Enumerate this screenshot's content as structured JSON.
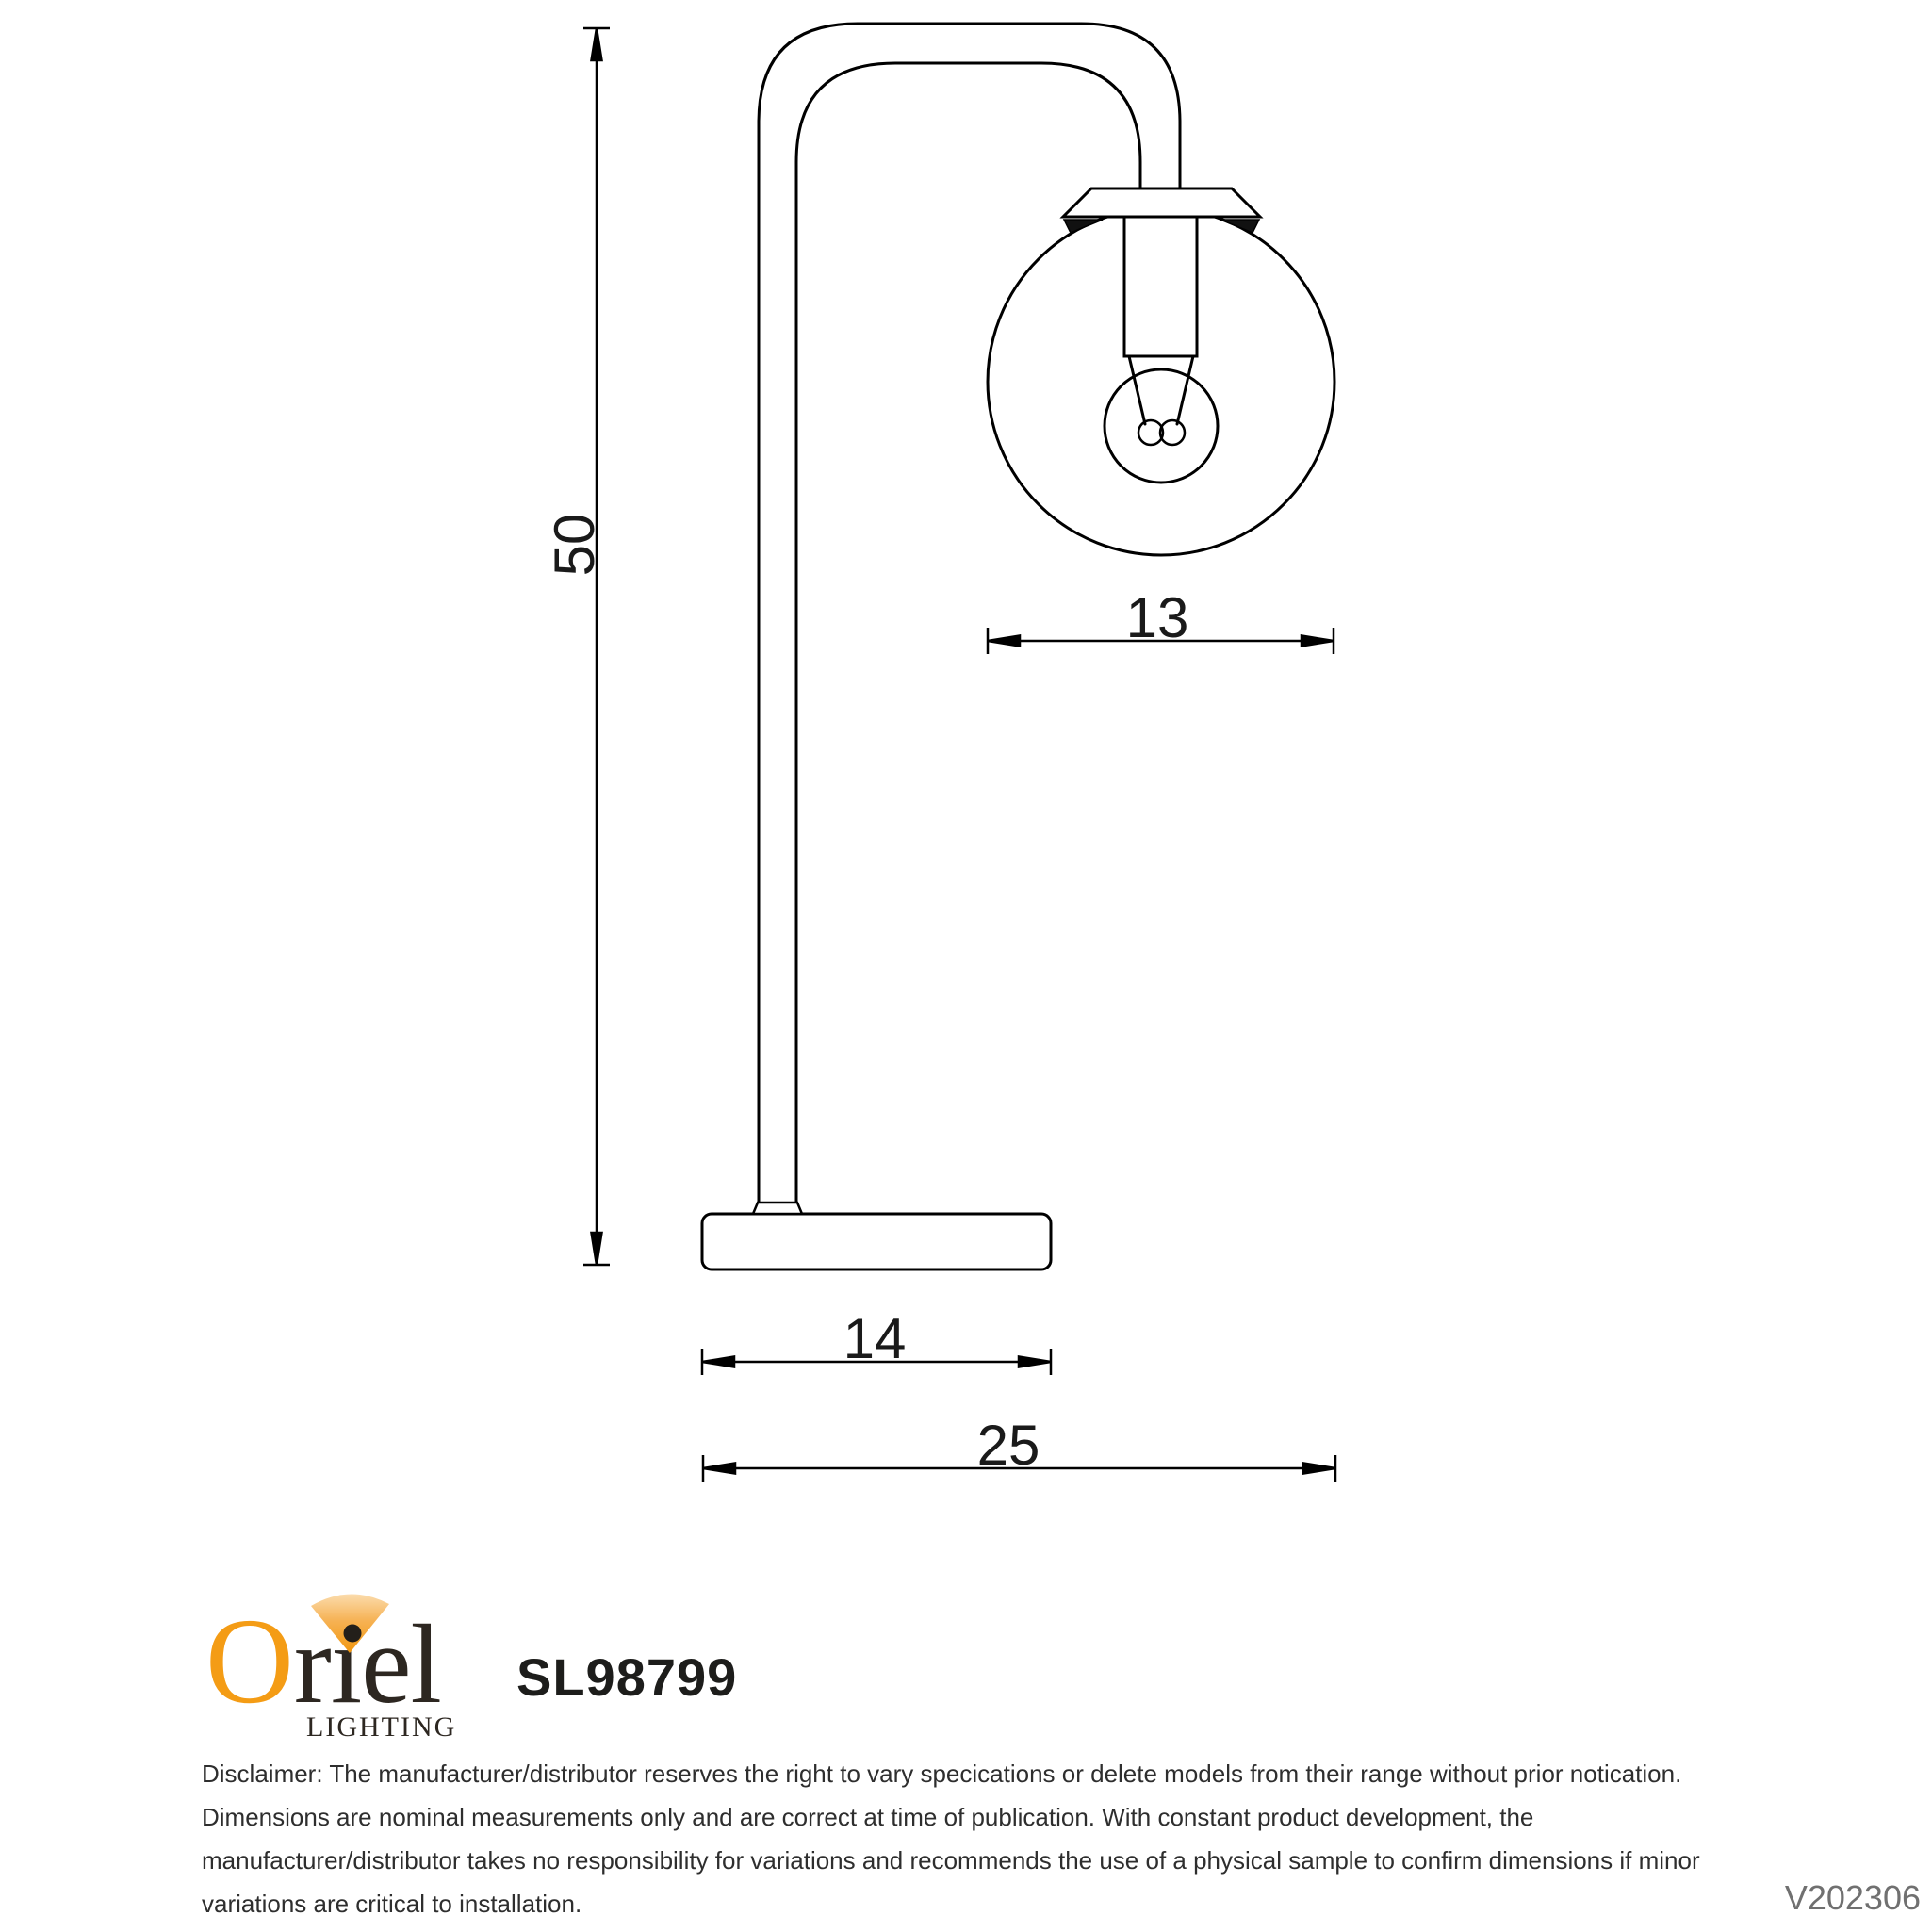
{
  "dimensions": {
    "height": "50",
    "shade_diameter": "13",
    "base_width": "14",
    "overall_depth": "25"
  },
  "logo": {
    "brand_o": "O",
    "brand_rest": "riel",
    "tagline": "LIGHTING",
    "orange": "#F49C15",
    "dark": "#2D2721"
  },
  "product": {
    "code": "SL98799"
  },
  "disclaimer": {
    "lines": [
      "Disclaimer: The manufacturer/distributor reserves the right to vary specications or delete models from their range without prior notication.",
      "Dimensions are nominal measurements only and are correct at time of publication. With constant product development, the",
      "manufacturer/distributor takes no responsibility for variations and recommends the use of a physical sample to confirm dimensions if minor",
      "variations are critical to installation."
    ]
  },
  "version": "V202306",
  "colors": {
    "drawing_line": "#000000",
    "dimension_text": "#1a1a1a",
    "disclaimer_text": "#2e2e2e",
    "version_text": "#707070"
  }
}
